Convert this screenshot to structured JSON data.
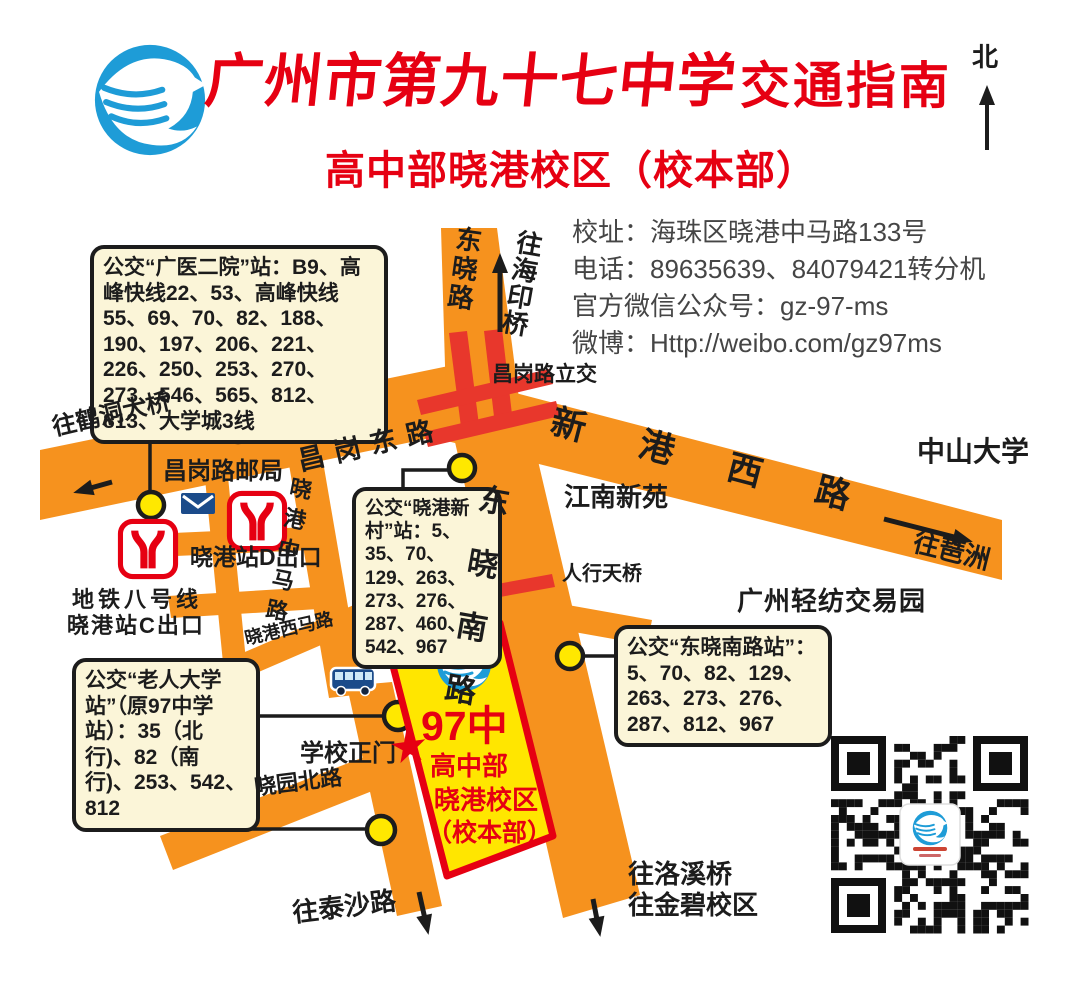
{
  "header": {
    "title": "广州市第九十七中学",
    "guide": "交通指南",
    "subtitle": "高中部晓港校区（校本部）",
    "north": "北"
  },
  "contact": {
    "address": "校址：海珠区晓港中马路133号",
    "phone": "电话：89635639、84079421转分机",
    "wechat": "官方微信公众号：gz-97-ms",
    "weibo": "微博：Http://weibo.com/gz97ms"
  },
  "bus_boxes": {
    "guangyi": "公交“广医二院”站：B9、高峰快线22、53、高峰快线55、69、70、82、188、190、197、206、221、226、250、253、270、273、546、565、812、813、大学城3线",
    "xiaogang_xincun": "公交“晓港新村”站：5、35、70、129、263、273、276、287、460、542、967",
    "dongxiao_nanlu": "公交“东晓南路站”：5、70、82、129、263、273、276、287、812、967",
    "laoren_daxue": "公交“老人大学站”（原97中学站）：35（北行)、82（南行)、253、542、812"
  },
  "labels": {
    "hedong": "往鹤洞大桥",
    "changgang_post": "昌岗路邮局",
    "changgang_dong": "昌岗东路",
    "dongxiao_lu": "东晓路",
    "haiyin": "往海印桥",
    "lijiao": "昌岗路立交",
    "xingang_xi": "新港西路",
    "zhongda": "中山大学",
    "pazhou": "往琶洲",
    "jiangnan": "江南新苑",
    "renxing": "人行天桥",
    "qingfang": "广州轻纺交易园",
    "zhongma": "晓港中马路",
    "xiaogang_d": "晓港站D出口",
    "metro_line": "地铁八号线",
    "metro_exit": "晓港站C出口",
    "xima": "晓港西马路",
    "dongxiao_nan": "东晓南路",
    "gate": "学校正门",
    "xiaoyuan": "晓园北路",
    "taisha": "往泰沙路",
    "luoxi": "往洛溪桥",
    "jinbi": "往金碧校区"
  },
  "school": {
    "badge": "97中",
    "line1": "高中部",
    "line2": "晓港校区",
    "line3": "（校本部）"
  },
  "colors": {
    "road_orange": "#F6921E",
    "accent_red": "#E60012",
    "box_bg": "#FBF5D8",
    "school_yellow": "#FFE600",
    "stop_yellow": "#FFE800",
    "logo_blue": "#1E9CD7",
    "bus_blue": "#1B4B8A"
  }
}
